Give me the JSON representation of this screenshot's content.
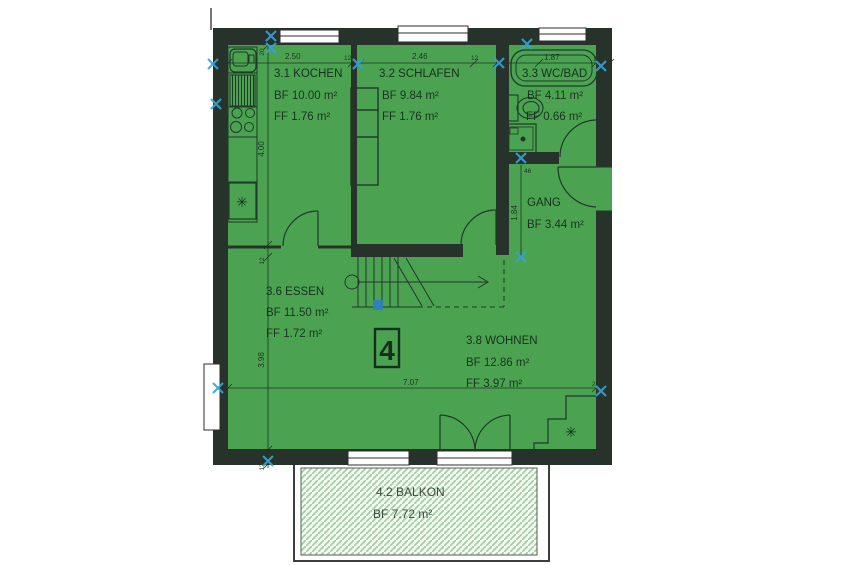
{
  "plan": {
    "unit": {
      "label": "4"
    },
    "rooms": {
      "kochen": {
        "name": "3.1 KOCHEN",
        "bf": "BF 10.00 m²",
        "ff": "FF 1.76 m²"
      },
      "schlafen": {
        "name": "3.2 SCHLAFEN",
        "bf": "BF 9.84 m²",
        "ff": "FF 1.76 m²"
      },
      "wcbad": {
        "name": "3.3 WC/BAD",
        "bf": "BF 4.11 m²",
        "ff": "FF 0.66 m²"
      },
      "gang": {
        "name": "GANG",
        "bf": "BF 3.44 m²"
      },
      "essen": {
        "name": "3.6 ESSEN",
        "bf": "BF 11.50 m²",
        "ff": "FF 1.72 m²"
      },
      "wohnen": {
        "name": "3.8 WOHNEN",
        "bf": "BF 12.86 m²",
        "ff": "FF 3.97 m²"
      },
      "balkon": {
        "name": "4.2 BALKON",
        "bf": "BF 7.72 m²"
      }
    },
    "dims": {
      "top_d1": "2.50",
      "top_w1": "12",
      "top_d2": "2.46",
      "top_w2": "12",
      "top_d3": "1.87",
      "top_w3": "15",
      "left_w0": "20",
      "left_d1": "4.00",
      "left_w1": "12",
      "left_d2": "3.98",
      "left_w2": "12",
      "gang_w1": "46",
      "gang_d1": "1.84",
      "bottom_d1": "7.07",
      "bottom_w1": "26"
    },
    "symbols": {
      "stove_star": "✳",
      "fireplace_star": "✳"
    },
    "colors": {
      "room_fill": "#4ba351",
      "wall": "#27332a",
      "linework": "#1f3a28",
      "marker_cyan": "#35a2d8",
      "marker_blue": "#2d7fc4",
      "balcony_hatch": "#a7cfa7",
      "balcony_bg": "#f4f9f4"
    }
  }
}
